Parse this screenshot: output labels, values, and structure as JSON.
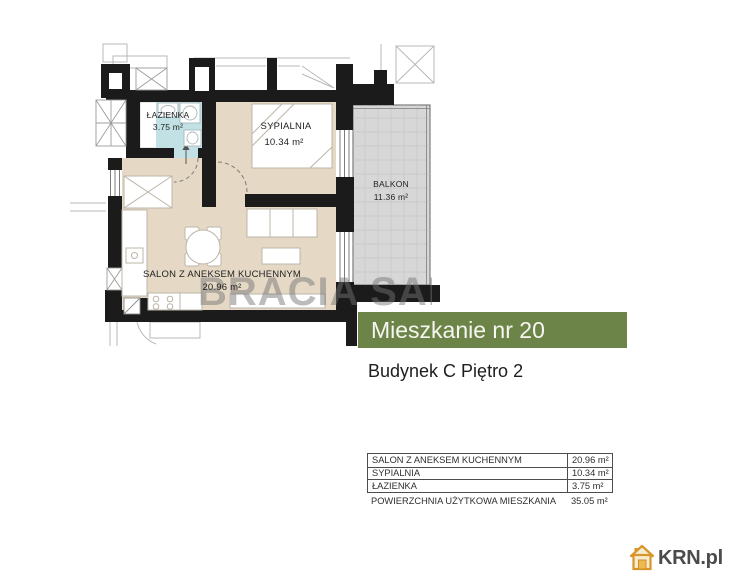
{
  "plan": {
    "rooms": {
      "bathroom": {
        "name": "ŁAZIENKA",
        "area": "3.75 m²"
      },
      "bedroom": {
        "name": "SYPIALNIA",
        "area": "10.34 m²"
      },
      "balcony": {
        "name": "BALKON",
        "area": "11.36 m²"
      },
      "living_room": {
        "name": "SALON Z ANEKSEM KUCHENNYM",
        "area": "20.96 m²"
      }
    },
    "watermark": "BRACIA SAD"
  },
  "banner": {
    "title": "Mieszkanie nr 20"
  },
  "building_info": "Budynek C Piętro 2",
  "area_table": {
    "rows": [
      {
        "label": "SALON Z ANEKSEM KUCHENNYM",
        "value": "20.96 m²"
      },
      {
        "label": "SYPIALNIA",
        "value": "10.34 m²"
      },
      {
        "label": "ŁAZIENKA",
        "value": "3.75 m²"
      }
    ],
    "summary": {
      "label": "POWIERZCHNIA UŻYTKOWA MIESZKANIA",
      "value": "35.05 m²"
    }
  },
  "logo": {
    "text": "KRN.pl",
    "icon": "house-icon"
  },
  "colors": {
    "banner_green": "#6d8449",
    "floor_beige": "#e5d9c5",
    "bathroom_blue": "#c2e1e5",
    "balcony_gray": "#d7d7d7",
    "wall_black": "#1b1b1b",
    "logo_orange": "#d9952a",
    "watermark_gray": "#737373"
  }
}
